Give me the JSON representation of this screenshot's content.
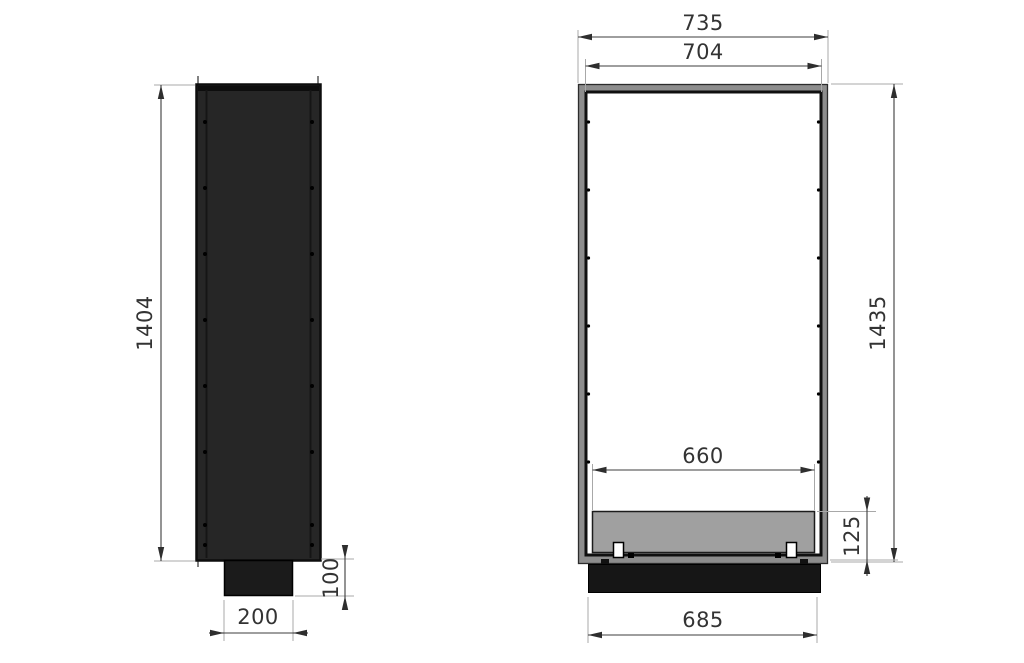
{
  "drawing": {
    "type": "technical-dimension-drawing",
    "views": {
      "side_view": {
        "label_height": "1404",
        "label_base_height": "100",
        "label_base_depth": "200"
      },
      "front_view": {
        "label_overall_width": "735",
        "label_opening_width": "704",
        "label_overall_height": "1435",
        "label_tray_width": "660",
        "label_tray_zone_height": "125",
        "label_base_width": "685"
      }
    },
    "colors": {
      "background": "#ffffff",
      "side_body_fill": "#262626",
      "body_outline": "#0d0d0d",
      "base_fill": "#1b1b1b",
      "frame_gray": "#8d8d8d",
      "inner_frame_black": "#101010",
      "opening_white": "#ffffff",
      "tray_gray": "#a0a0a0",
      "dimension_line": "#3c3c3c",
      "extension_line": "#a8a8a8",
      "text": "#333333"
    }
  }
}
